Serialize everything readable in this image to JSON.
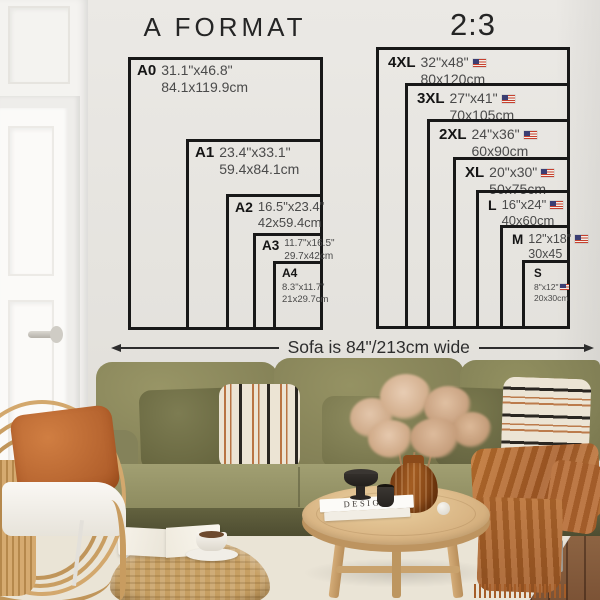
{
  "left_chart": {
    "title": "A FORMAT",
    "sizes": [
      {
        "code": "A0",
        "inches": "31.1\"x46.8\"",
        "cm": "84.1x119.9cm"
      },
      {
        "code": "A1",
        "inches": "23.4\"x33.1\"",
        "cm": "59.4x84.1cm"
      },
      {
        "code": "A2",
        "inches": "16.5\"x23.4\"",
        "cm": "42x59.4cm"
      },
      {
        "code": "A3",
        "inches": "11.7\"x16.5\"",
        "cm": "29.7x42cm"
      },
      {
        "code": "A4",
        "inches": "8.3\"x11.7\"",
        "cm": "21x29.7cm"
      }
    ]
  },
  "right_chart": {
    "title": "2:3",
    "sizes": [
      {
        "code": "4XL",
        "inches": "32\"x48\"",
        "cm": "80x120cm",
        "flag": "us-flag"
      },
      {
        "code": "3XL",
        "inches": "27\"x41\"",
        "cm": "70x105cm",
        "flag": "us-flag"
      },
      {
        "code": "2XL",
        "inches": "24\"x36\"",
        "cm": "60x90cm",
        "flag": "us-flag"
      },
      {
        "code": "XL",
        "inches": "20\"x30\"",
        "cm": "50x75cm",
        "flag": "us-flag"
      },
      {
        "code": "L",
        "inches": "16\"x24\"",
        "cm": "40x60cm",
        "flag": "us-flag"
      },
      {
        "code": "M",
        "inches": "12\"x18\"",
        "cm": "30x45",
        "flag": "us-flag"
      },
      {
        "code": "S",
        "inches": "8\"x12\"",
        "cm": "20x30cm",
        "flag": "us-flag"
      }
    ]
  },
  "sofa_annotation": {
    "label": "Sofa is 84\"/213cm wide"
  },
  "scene": {
    "book_title": "DESIGN"
  },
  "colors": {
    "chart_line": "#181818",
    "wall": "#e5e3df",
    "sofa_olive": "#8d8b5f",
    "pillow_rust": "#bc6a33",
    "throw_terracotta": "#b96a31",
    "rattan": "#d2a76c",
    "rug": "#eae4d6",
    "wood_floor": "#8a5f3e"
  }
}
